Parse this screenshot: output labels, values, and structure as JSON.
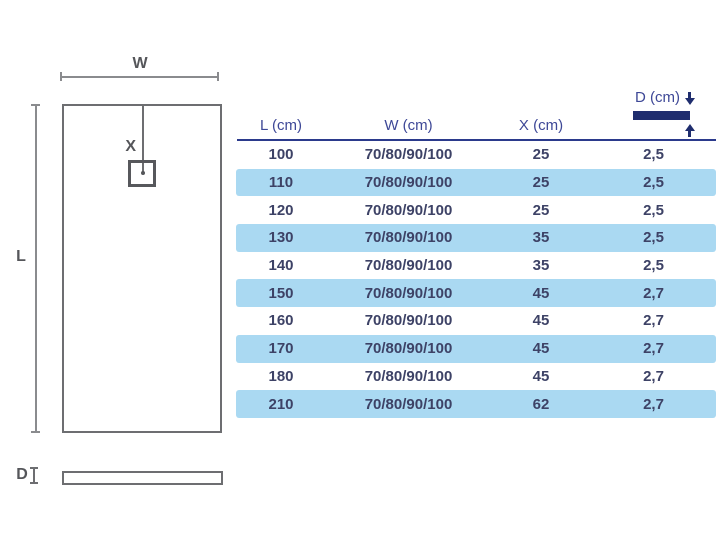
{
  "diagram": {
    "top_view": {
      "width_label": "W",
      "length_label": "L",
      "drain_label": "X"
    },
    "side_view": {
      "depth_label": "D"
    }
  },
  "table": {
    "columns": [
      {
        "key": "l",
        "label": "L (cm)"
      },
      {
        "key": "w",
        "label": "W (cm)"
      },
      {
        "key": "x",
        "label": "X (cm)"
      },
      {
        "key": "d",
        "label": "D (cm)"
      }
    ],
    "rows": [
      {
        "l": "100",
        "w": "70/80/90/100",
        "x": "25",
        "d": "2,5"
      },
      {
        "l": "110",
        "w": "70/80/90/100",
        "x": "25",
        "d": "2,5"
      },
      {
        "l": "120",
        "w": "70/80/90/100",
        "x": "25",
        "d": "2,5"
      },
      {
        "l": "130",
        "w": "70/80/90/100",
        "x": "35",
        "d": "2,5"
      },
      {
        "l": "140",
        "w": "70/80/90/100",
        "x": "35",
        "d": "2,5"
      },
      {
        "l": "150",
        "w": "70/80/90/100",
        "x": "45",
        "d": "2,7"
      },
      {
        "l": "160",
        "w": "70/80/90/100",
        "x": "45",
        "d": "2,7"
      },
      {
        "l": "170",
        "w": "70/80/90/100",
        "x": "45",
        "d": "2,7"
      },
      {
        "l": "180",
        "w": "70/80/90/100",
        "x": "45",
        "d": "2,7"
      },
      {
        "l": "210",
        "w": "70/80/90/100",
        "x": "62",
        "d": "2,7"
      }
    ]
  },
  "colors": {
    "header_text": "#3e4897",
    "header_rule": "#2b3a8c",
    "thickness_bar": "#1f2d6e",
    "alt_row_background": "#aad9f2",
    "cell_text": "#3d4266",
    "diagram_line": "#6d6e71",
    "diagram_label": "#55565a"
  }
}
